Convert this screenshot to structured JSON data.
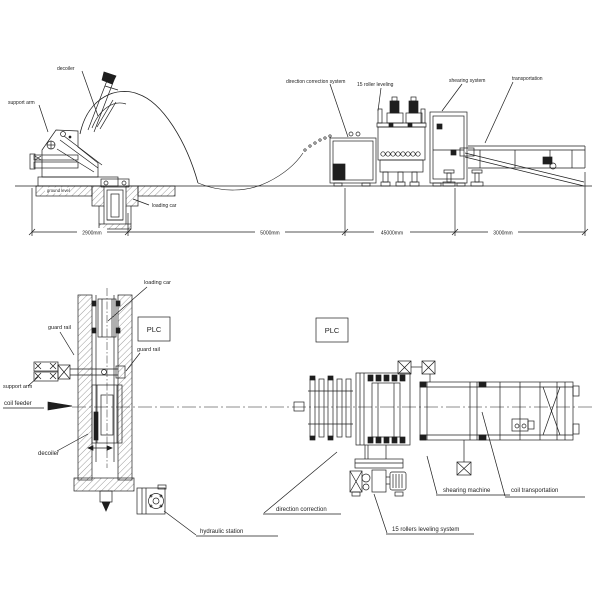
{
  "side_view": {
    "labels": {
      "support_arm": "support arm",
      "decoiler": "decoiler",
      "ground_level": "ground level",
      "loading_car": "loading car",
      "direction_correction_system": "direction correction system",
      "roller_leveling_15": "15 roller leveling",
      "shearing_system": "shearing system",
      "transportation": "transportation"
    },
    "dimensions": {
      "d1": "2900mm",
      "d2": "5000mm",
      "d3": "45000mm",
      "d4": "3000mm"
    }
  },
  "plan_left": {
    "labels": {
      "loading_car": "loading car",
      "guard_rail_left": "guard rail",
      "guard_rail_right": "guard rail",
      "support_arm": "support arm",
      "coil_feeder": "coil feeder",
      "decoiler": "decoiler",
      "plc": "PLC",
      "hydraulic_station": "hydraulic station"
    }
  },
  "plan_right": {
    "labels": {
      "plc": "PLC",
      "direction_correction": "direction correction",
      "rollers_leveling_system": "15 rollers leveling system",
      "shearing_machine": "shearing machine",
      "coil_transportation": "coil transportation"
    }
  }
}
